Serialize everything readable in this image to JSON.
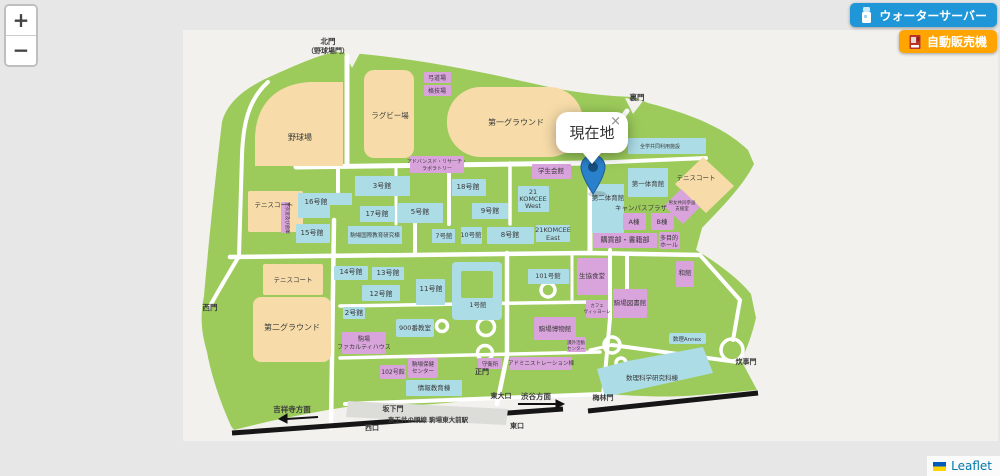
{
  "zoom_control": {
    "zoom_in": "+",
    "zoom_out": "−"
  },
  "action_buttons": {
    "water_server": "ウォーターサーバー",
    "vending_machine": "自動販売機"
  },
  "popup": {
    "text": "現在地",
    "close": "×"
  },
  "attribution": {
    "text": "Leaflet"
  },
  "colors": {
    "accent_blue": "#1E96D8",
    "accent_orange": "#FFA400",
    "campus_green": "#9CCB5B",
    "field_tan": "#F7DCA9",
    "building_blue": "#ACDCE6",
    "building_pink": "#D9A3DC",
    "marker_blue": "#2A81CB",
    "railway_black": "#161616",
    "road_white": "#FFFFFF"
  },
  "map_labels": [
    {
      "t": "野球場",
      "x": 300,
      "y": 140,
      "s": 8
    },
    {
      "t": "ラグビー場",
      "x": 390,
      "y": 118,
      "s": 7.5
    },
    {
      "t": "第一グラウンド",
      "x": 516,
      "y": 125,
      "s": 8
    },
    {
      "t": "第二グラウンド",
      "x": 292,
      "y": 330,
      "s": 8
    },
    {
      "t": "テニスコート",
      "x": 274,
      "y": 207,
      "s": 6.5
    },
    {
      "t": "テニスコート",
      "x": 293,
      "y": 282,
      "s": 6.5
    },
    {
      "t": "テニスコート",
      "x": 696,
      "y": 180,
      "s": 6.5
    },
    {
      "t": "北門",
      "x": 328,
      "y": 44,
      "s": 7.5,
      "b": 1,
      "c": "#1a1a1a"
    },
    {
      "t": "（野球場門）",
      "x": 328,
      "y": 53,
      "s": 7,
      "b": 1,
      "c": "#1a1a1a"
    },
    {
      "t": "裏門",
      "x": 637,
      "y": 100,
      "s": 7.5,
      "b": 1,
      "c": "#1a1a1a"
    },
    {
      "t": "西門",
      "x": 210,
      "y": 310,
      "s": 7.5,
      "b": 1,
      "c": "#1a1a1a"
    },
    {
      "t": "正門",
      "x": 482,
      "y": 374,
      "s": 7,
      "b": 1,
      "c": "#1a1a1a"
    },
    {
      "t": "東大口",
      "x": 501,
      "y": 398,
      "s": 7,
      "b": 1,
      "c": "#1a1a1a"
    },
    {
      "t": "坂下門",
      "x": 393,
      "y": 411,
      "s": 7,
      "b": 1,
      "c": "#1a1a1a"
    },
    {
      "t": "梅林門",
      "x": 603,
      "y": 400,
      "s": 7,
      "b": 1,
      "c": "#1a1a1a"
    },
    {
      "t": "炊事門",
      "x": 746,
      "y": 364,
      "s": 7,
      "b": 1,
      "c": "#1a1a1a"
    },
    {
      "t": "西口",
      "x": 372,
      "y": 430,
      "s": 7,
      "b": 1,
      "c": "#1a1a1a"
    },
    {
      "t": "東口",
      "x": 517,
      "y": 428,
      "s": 7,
      "b": 1,
      "c": "#1a1a1a"
    },
    {
      "t": "渋谷方面",
      "x": 536,
      "y": 399,
      "s": 7.5,
      "b": 1,
      "c": "#1a1a1a"
    },
    {
      "t": "吉祥寺方面",
      "x": 292,
      "y": 412,
      "s": 7.5,
      "b": 1,
      "c": "#1a1a1a"
    },
    {
      "t": "京王井の頭線 駒場東大前駅",
      "x": 428,
      "y": 422,
      "s": 6.5,
      "b": 1,
      "c": "#1a1a1a"
    },
    {
      "t": "3号館",
      "x": 382,
      "y": 188,
      "s": 7
    },
    {
      "t": "16号館",
      "x": 316,
      "y": 204,
      "s": 7
    },
    {
      "t": "17号館",
      "x": 377,
      "y": 216,
      "s": 7
    },
    {
      "t": "5号館",
      "x": 420,
      "y": 214,
      "s": 7
    },
    {
      "t": "15号館",
      "x": 312,
      "y": 235,
      "s": 7
    },
    {
      "t": "駒場国際教育研究棟",
      "x": 375,
      "y": 237,
      "s": 5.5
    },
    {
      "t": "18号館",
      "x": 468,
      "y": 189,
      "s": 7
    },
    {
      "t": "9号館",
      "x": 490,
      "y": 213,
      "s": 7
    },
    {
      "t": "7号館",
      "x": 444,
      "y": 238,
      "s": 6.5
    },
    {
      "t": "10号館",
      "x": 471,
      "y": 237,
      "s": 6.5
    },
    {
      "t": "8号館",
      "x": 510,
      "y": 237,
      "s": 7
    },
    {
      "t": "21",
      "x": 533,
      "y": 194,
      "s": 6.5
    },
    {
      "t": "KOMCEE",
      "x": 533,
      "y": 201,
      "s": 6.5
    },
    {
      "t": "West",
      "x": 533,
      "y": 208,
      "s": 6.5
    },
    {
      "t": "21KOMCEE",
      "x": 553,
      "y": 232,
      "s": 6.5
    },
    {
      "t": "East",
      "x": 553,
      "y": 240,
      "s": 6.5
    },
    {
      "t": "学生会館",
      "x": 551,
      "y": 173,
      "s": 6.5
    },
    {
      "t": "第二体育館",
      "x": 608,
      "y": 200,
      "s": 6.5
    },
    {
      "t": "第一体育館",
      "x": 648,
      "y": 186,
      "s": 6.5
    },
    {
      "t": "全学共同利用施設",
      "x": 660,
      "y": 148,
      "s": 5
    },
    {
      "t": "男女共同参画",
      "x": 682,
      "y": 204,
      "s": 4.5
    },
    {
      "t": "支援室",
      "x": 682,
      "y": 210,
      "s": 4.5
    },
    {
      "t": "キャンパスプラザ",
      "x": 641,
      "y": 210,
      "s": 6.5
    },
    {
      "t": "A棟",
      "x": 634,
      "y": 224,
      "s": 6.5
    },
    {
      "t": "B棟",
      "x": 662,
      "y": 224,
      "s": 6.5
    },
    {
      "t": "購買部・書籍部",
      "x": 625,
      "y": 242,
      "s": 7
    },
    {
      "t": "多目的",
      "x": 669,
      "y": 240,
      "s": 6
    },
    {
      "t": "ホール",
      "x": 669,
      "y": 247,
      "s": 6
    },
    {
      "t": "和館",
      "x": 685,
      "y": 275,
      "s": 6.5
    },
    {
      "t": "生協食堂",
      "x": 592,
      "y": 278,
      "s": 6.5
    },
    {
      "t": "駒場図書館",
      "x": 630,
      "y": 305,
      "s": 6.5
    },
    {
      "t": "カフェ",
      "x": 597,
      "y": 307,
      "s": 4.5
    },
    {
      "t": "ヴィッヨーレ",
      "x": 597,
      "y": 313,
      "s": 4.5
    },
    {
      "t": "101号館",
      "x": 548,
      "y": 278,
      "s": 6.5
    },
    {
      "t": "1号館",
      "x": 478,
      "y": 307,
      "s": 6.5
    },
    {
      "t": "11号館",
      "x": 431,
      "y": 291,
      "s": 7
    },
    {
      "t": "12号館",
      "x": 381,
      "y": 296,
      "s": 7
    },
    {
      "t": "13号館",
      "x": 388,
      "y": 275,
      "s": 7
    },
    {
      "t": "14号館",
      "x": 351,
      "y": 274,
      "s": 7
    },
    {
      "t": "2号館",
      "x": 354,
      "y": 315,
      "s": 7
    },
    {
      "t": "900番教室",
      "x": 415,
      "y": 330,
      "s": 6.5
    },
    {
      "t": "駒場",
      "x": 364,
      "y": 341,
      "s": 6
    },
    {
      "t": "ファカルティハウス",
      "x": 364,
      "y": 349,
      "s": 6
    },
    {
      "t": "102号館",
      "x": 393,
      "y": 374,
      "s": 6
    },
    {
      "t": "駒場保健",
      "x": 423,
      "y": 366,
      "s": 5.5
    },
    {
      "t": "センター",
      "x": 423,
      "y": 373,
      "s": 5.5
    },
    {
      "t": "情報教育棟",
      "x": 434,
      "y": 390,
      "s": 6.5
    },
    {
      "t": "守衛所",
      "x": 490,
      "y": 366,
      "s": 5.5
    },
    {
      "t": "アドミニストレーション棟",
      "x": 541,
      "y": 365,
      "s": 5.5
    },
    {
      "t": "駒場博物館",
      "x": 555,
      "y": 331,
      "s": 6.5
    },
    {
      "t": "課外活動",
      "x": 576,
      "y": 344,
      "s": 4.5
    },
    {
      "t": "センター",
      "x": 576,
      "y": 350,
      "s": 4.5
    },
    {
      "t": "数理科学研究科棟",
      "x": 652,
      "y": 380,
      "s": 6.5
    },
    {
      "t": "数理Annex",
      "x": 687,
      "y": 341,
      "s": 5.5
    },
    {
      "t": "弓道場",
      "x": 437,
      "y": 80,
      "s": 6
    },
    {
      "t": "格技場",
      "x": 437,
      "y": 93,
      "s": 6
    },
    {
      "t": "アドバンスド・リサーチ・",
      "x": 437,
      "y": 163,
      "s": 5
    },
    {
      "t": "ラボラトリー",
      "x": 437,
      "y": 170,
      "s": 5
    },
    {
      "t": "更衣室及び倉庫",
      "x": 286,
      "y": 218,
      "s": 4.5,
      "r": 90
    }
  ]
}
